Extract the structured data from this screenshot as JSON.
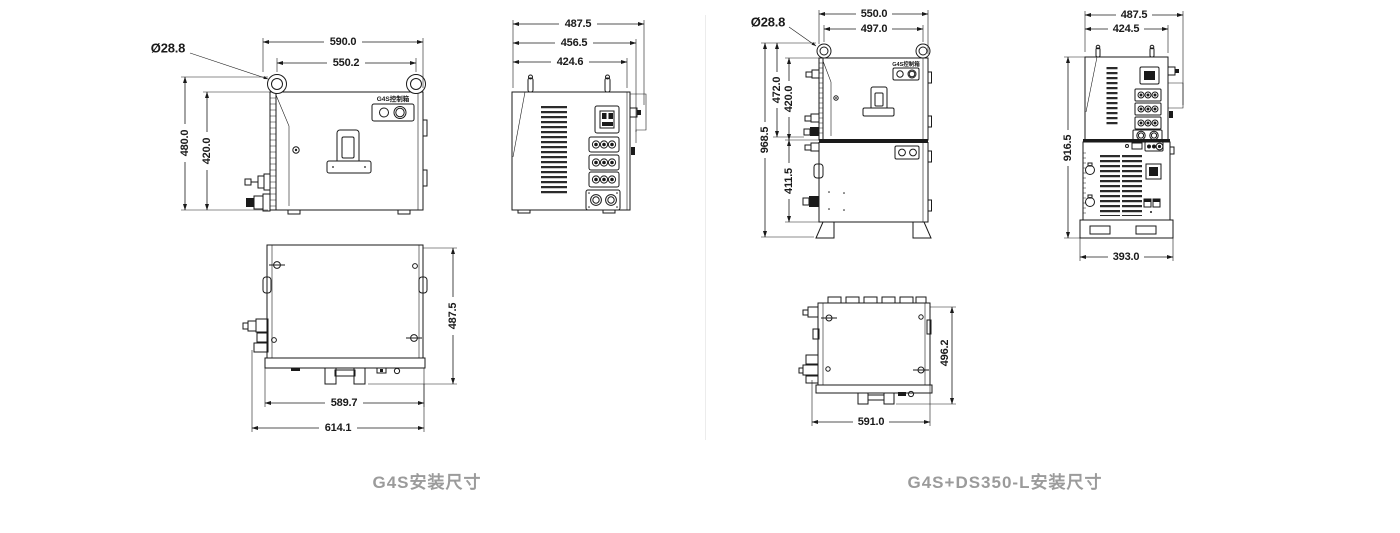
{
  "page": {
    "bg": "#ffffff",
    "divider_color": "#ececec",
    "caption_color": "#9b9b9b",
    "line_color": "#1a1a1a"
  },
  "left": {
    "caption": "G4S安装尺寸",
    "front": {
      "device_label": "G4S控制箱",
      "dim_top_width": "590.0",
      "dim_inner_width": "550.2",
      "dim_eyelet_diameter": "Ø28.8",
      "dim_outer_height": "480.0",
      "dim_inner_height": "420.0"
    },
    "side": {
      "dim_depth_outer": "487.5",
      "dim_depth_mid": "456.5",
      "dim_depth_inner": "424.6"
    },
    "top": {
      "dim_depth": "487.5",
      "dim_width": "589.7",
      "dim_width_outer": "614.1"
    }
  },
  "right": {
    "caption": "G4S+DS350-L安装尺寸",
    "front": {
      "device_label": "G4S控制箱",
      "dim_top_width": "550.0",
      "dim_inner_width": "497.0",
      "dim_eyelet_diameter": "Ø28.8",
      "dim_total_height": "968.5",
      "dim_upper_outer_height": "472.0",
      "dim_upper_height": "420.0",
      "dim_lower_height": "411.5"
    },
    "side": {
      "dim_depth_outer": "487.5",
      "dim_depth_inner": "424.5",
      "dim_height": "916.5",
      "dim_base_width": "393.0"
    },
    "top": {
      "dim_depth": "496.2",
      "dim_width": "591.0"
    }
  }
}
